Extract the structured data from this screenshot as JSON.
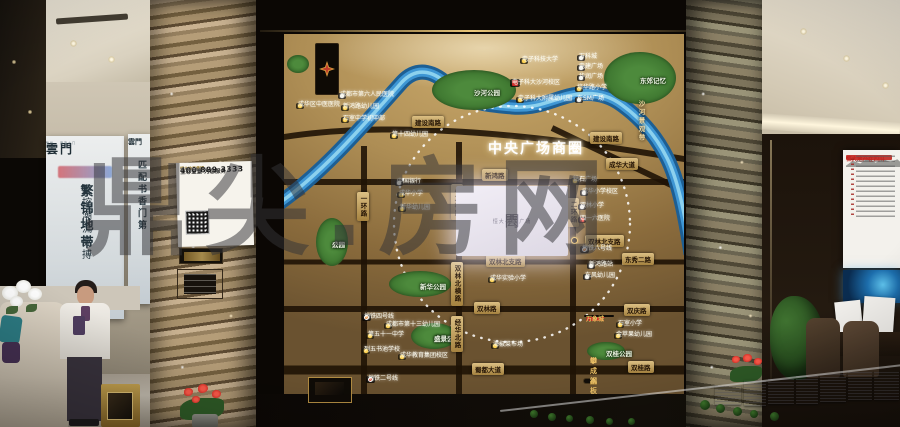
{
  "watermark": "鼎尖.房网",
  "left": {
    "banner_main": {
      "logo": "雲門",
      "tagline": "繁华 · 潮流之门",
      "slogan_right": "繁锦地带",
      "slogan_left": "掌控潮流脉搏"
    },
    "banner_side": {
      "logo": "雲門",
      "slogan": "匹配书香门第"
    },
    "notice": {
      "brand": "恒大地产集团",
      "title": "全心全意 为您服务",
      "hotline": "24小时服务热线",
      "phone": "400 889 3333",
      "caption": "客户服务监督平台"
    }
  },
  "map": {
    "title": "中央广场商圈",
    "screen": {
      "glyph_top": "雲",
      "name": "恒大·中央广场",
      "glyph_bottom": "門"
    },
    "riverside": "沙河景观带",
    "mixc": {
      "logo": "mixc",
      "name": "万象城"
    },
    "pansteel": "攀成钢板块",
    "parks": [
      {
        "lines": [
          "沙河公园"
        ],
        "cx": 190,
        "cy": 56,
        "rx": 42,
        "ry": 20
      },
      {
        "lines": [
          "东郊记忆"
        ],
        "cx": 356,
        "cy": 44,
        "rx": 36,
        "ry": 26
      },
      {
        "lines": [
          "成华",
          "公园"
        ],
        "cx": 48,
        "cy": 208,
        "rx": 16,
        "ry": 24
      },
      {
        "lines": [
          "新华公园"
        ],
        "cx": 136,
        "cy": 250,
        "rx": 31,
        "ry": 13
      },
      {
        "lines": [
          "成华区",
          "盛景公园"
        ],
        "cx": 150,
        "cy": 302,
        "rx": 23,
        "ry": 13
      },
      {
        "lines": [
          "双桂公园"
        ],
        "cx": 322,
        "cy": 317,
        "rx": 19,
        "ry": 9
      },
      {
        "lines": [],
        "cx": 14,
        "cy": 30,
        "rx": 11,
        "ry": 9
      }
    ],
    "road_labels": [
      {
        "t": "建设南路",
        "x": 128,
        "y": 82
      },
      {
        "t": "建设南路",
        "x": 306,
        "y": 98
      },
      {
        "t": "成华大道",
        "x": 322,
        "y": 124
      },
      {
        "t": "新鸿路",
        "x": 198,
        "y": 135
      },
      {
        "t": "双林北支路",
        "x": 202,
        "y": 221
      },
      {
        "t": "双林北支路",
        "x": 301,
        "y": 201
      },
      {
        "t": "东秀二路",
        "x": 338,
        "y": 219
      },
      {
        "t": "双林路",
        "x": 190,
        "y": 268
      },
      {
        "t": "双庆路",
        "x": 340,
        "y": 270
      },
      {
        "t": "蜀都大道",
        "x": 188,
        "y": 329
      },
      {
        "t": "双桂路",
        "x": 344,
        "y": 327
      },
      {
        "t": "一环路",
        "x": 73,
        "y": 158,
        "v": 1
      },
      {
        "t": "小龙桥路",
        "x": 167,
        "y": 150,
        "v": 1
      },
      {
        "t": "二环路",
        "x": 283,
        "y": 164,
        "v": 1
      },
      {
        "t": "双林北横路",
        "x": 167,
        "y": 228,
        "v": 1
      },
      {
        "t": "经华北路",
        "x": 167,
        "y": 282,
        "v": 1
      }
    ],
    "pois": [
      {
        "t": "成华区中医医院",
        "d": "y",
        "x": 12,
        "y": 69
      },
      {
        "t": "成都市第六人民医院",
        "d": "w",
        "x": 54,
        "y": 59
      },
      {
        "t": "新鸿路幼儿园",
        "d": "y",
        "x": 57,
        "y": 71
      },
      {
        "t": "石室中学初中部",
        "d": "y",
        "x": 57,
        "y": 83
      },
      {
        "t": "第十四幼儿园",
        "d": "y",
        "x": 106,
        "y": 99
      },
      {
        "t": "电子科技大学",
        "d": "y",
        "x": 236,
        "y": 24
      },
      {
        "t": "电子科大沙河校区",
        "d": "rl",
        "x": 226,
        "y": 45
      },
      {
        "t": "电子科大附属幼儿园",
        "d": "y",
        "x": 232,
        "y": 63
      },
      {
        "t": "万科城",
        "d": "w",
        "x": 293,
        "y": 21
      },
      {
        "t": "电建广场",
        "d": "w",
        "x": 293,
        "y": 31
      },
      {
        "t": "华润广场",
        "d": "w",
        "x": 293,
        "y": 41
      },
      {
        "t": "培华路小学",
        "d": "y",
        "x": 291,
        "y": 52
      },
      {
        "t": "东SM广场",
        "d": "w",
        "x": 291,
        "y": 63
      },
      {
        "t": "钻石广场",
        "d": "y",
        "x": 287,
        "y": 144
      },
      {
        "t": "成华小学校区",
        "d": "w",
        "x": 296,
        "y": 156
      },
      {
        "t": "双林小学",
        "d": "w",
        "x": 294,
        "y": 170
      },
      {
        "t": "四一六医院",
        "d": "r",
        "x": 294,
        "y": 183
      },
      {
        "t": "新鸿路站",
        "d": "w",
        "x": 303,
        "y": 229
      },
      {
        "t": "东风幼儿园",
        "d": "w",
        "x": 299,
        "y": 240
      },
      {
        "t": "成华实验小学",
        "d": "y",
        "x": 204,
        "y": 243
      },
      {
        "t": "中国银行",
        "d": "w",
        "x": 111,
        "y": 146
      },
      {
        "t": "成华小学",
        "d": "y",
        "x": 113,
        "y": 158
      },
      {
        "t": "新华幼儿园",
        "d": "y",
        "x": 114,
        "y": 172
      },
      {
        "t": "成都市第十三幼儿园",
        "d": "y",
        "x": 100,
        "y": 289
      },
      {
        "t": "第五十一中学",
        "d": "y",
        "x": 82,
        "y": 299
      },
      {
        "t": "列五书池学校",
        "d": "y",
        "x": 78,
        "y": 314
      },
      {
        "t": "成华教育集团校区",
        "d": "y",
        "x": 114,
        "y": 320
      },
      {
        "t": "海椒菜市场",
        "d": "y",
        "x": 207,
        "y": 309
      },
      {
        "t": "石室小学",
        "d": "y",
        "x": 332,
        "y": 288
      },
      {
        "t": "金苹果幼儿园",
        "d": "y",
        "x": 330,
        "y": 299
      }
    ],
    "metro": [
      {
        "t": "地铁四号线",
        "x": 78,
        "y": 280,
        "c": "#e0761e"
      },
      {
        "t": "地铁二号线",
        "x": 82,
        "y": 342,
        "c": "#d63a26"
      },
      {
        "t": "地铁八号线",
        "x": 296,
        "y": 212,
        "c": "#e0761e"
      }
    ],
    "accent_colors": {
      "poi_dot_yellow": "#ffd24a",
      "river_blue": "#3e96d4",
      "park_green": "#3e7c33",
      "road_ribbon": "#c8a75e"
    }
  },
  "right": {
    "poster_title": "恒大地产在四川"
  }
}
